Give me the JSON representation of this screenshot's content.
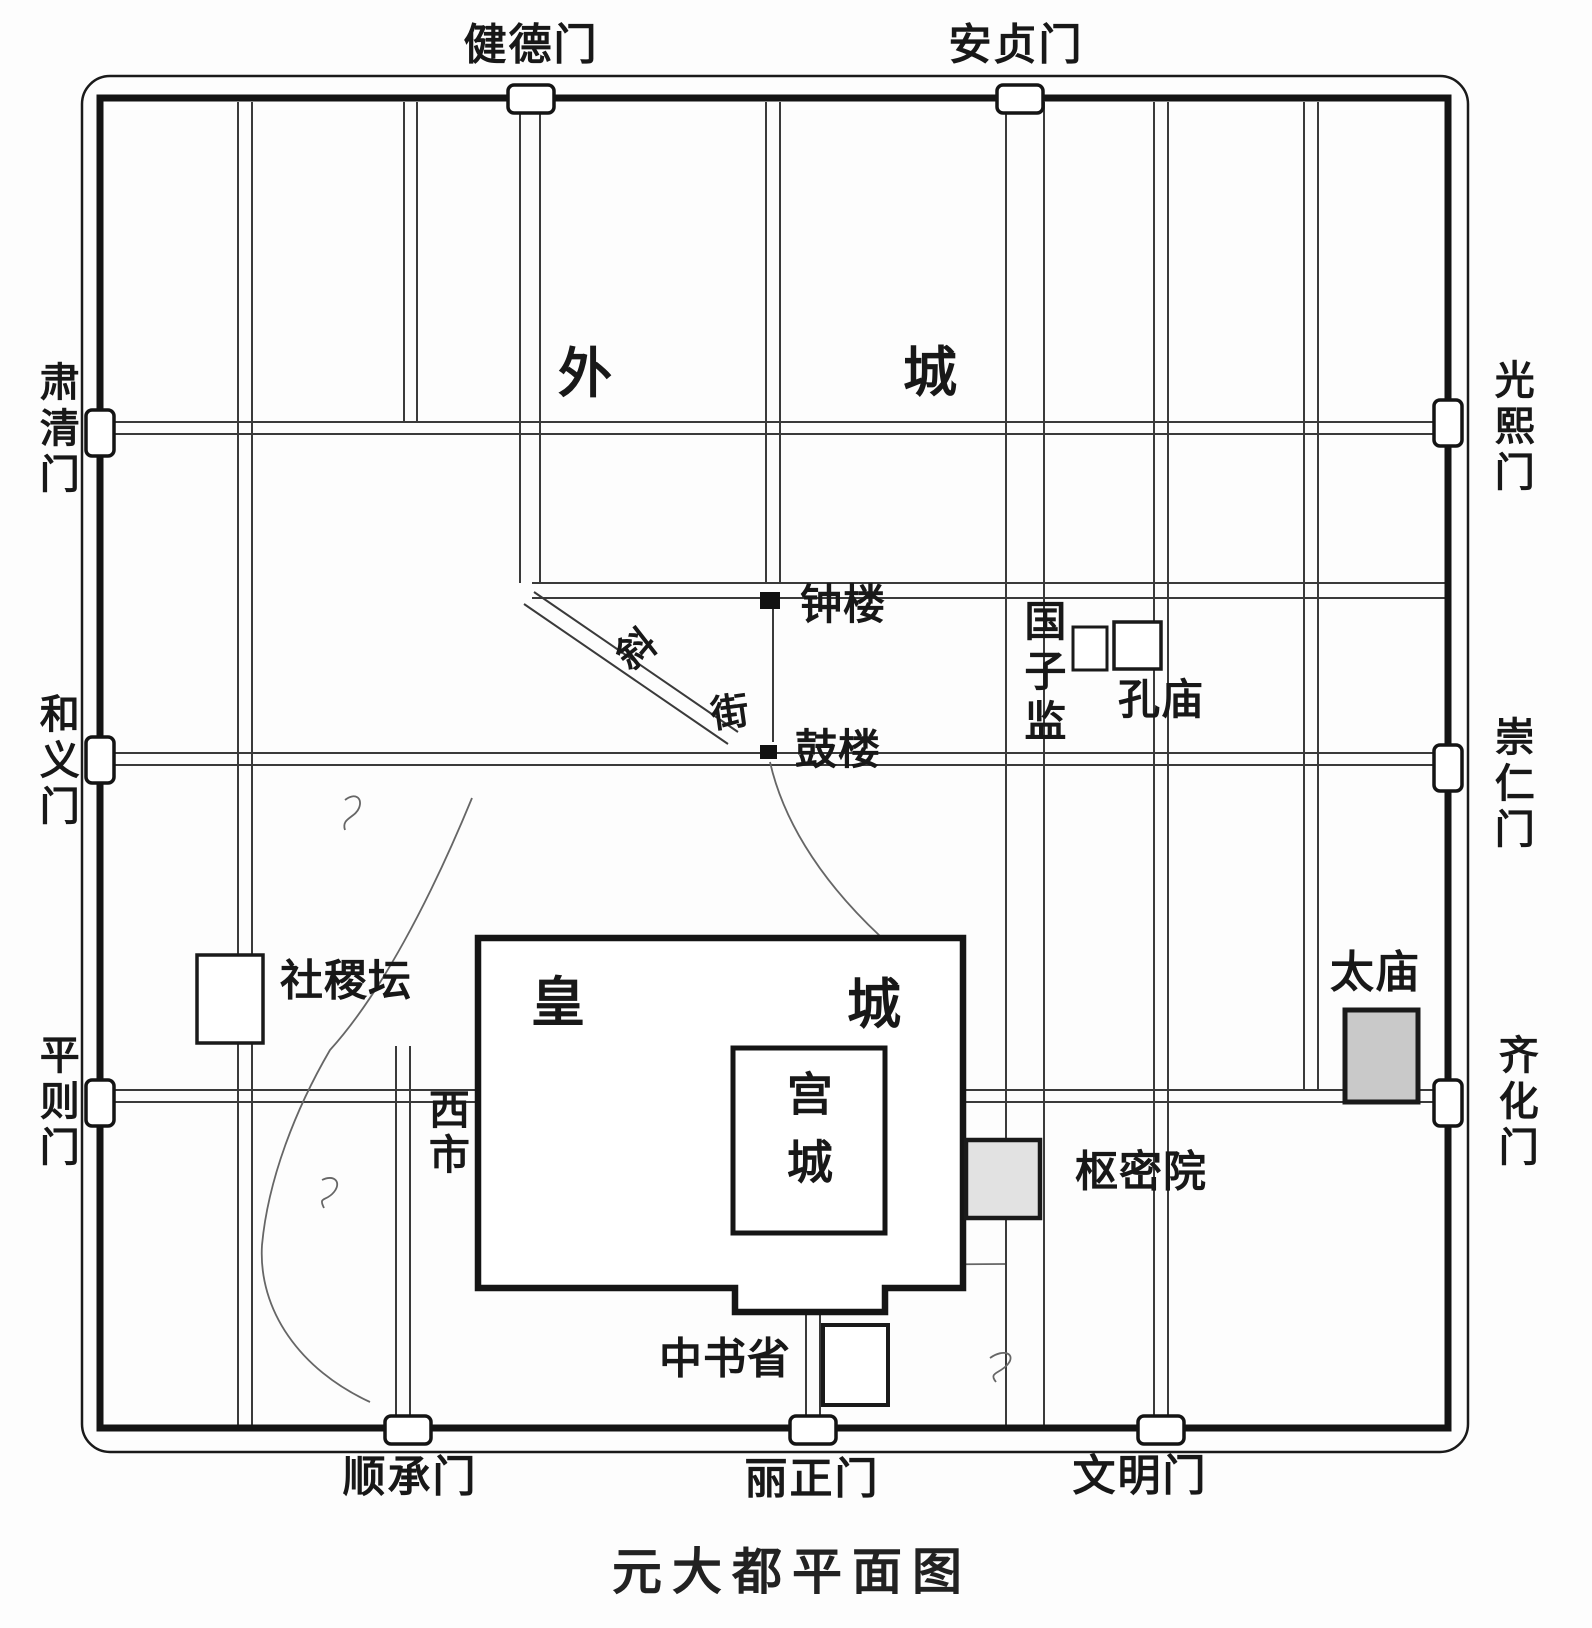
{
  "title": "元大都平面图",
  "colors": {
    "ink": "#1a1a1a",
    "wall": "#141414",
    "street": "#3a3a3a",
    "ancestral_temple_fill": "#c9c9c9",
    "privy_council_fill": "#e2e2e2",
    "background": "#fdfdfd"
  },
  "gates": {
    "north": [
      "健德门",
      "安贞门"
    ],
    "west": [
      "肃清门",
      "和义门",
      "平则门"
    ],
    "east": [
      "光熙门",
      "崇仁门",
      "齐化门"
    ],
    "south": [
      "顺承门",
      "丽正门",
      "文明门"
    ]
  },
  "regions": {
    "outer_city": [
      "外",
      "城"
    ],
    "imperial_city": [
      "皇",
      "城"
    ],
    "palace_city": "宫城"
  },
  "landmarks": {
    "bell_tower": "钟楼",
    "drum_tower": "鼓楼",
    "diagonal_street": [
      "斜",
      "街"
    ],
    "imperial_academy": "国子监",
    "confucius_temple": "孔庙",
    "sheji_altar": "社稷坛",
    "ancestral_temple": "太庙",
    "privy_council": "枢密院",
    "secretariat": "中书省",
    "west_market": "西市"
  }
}
